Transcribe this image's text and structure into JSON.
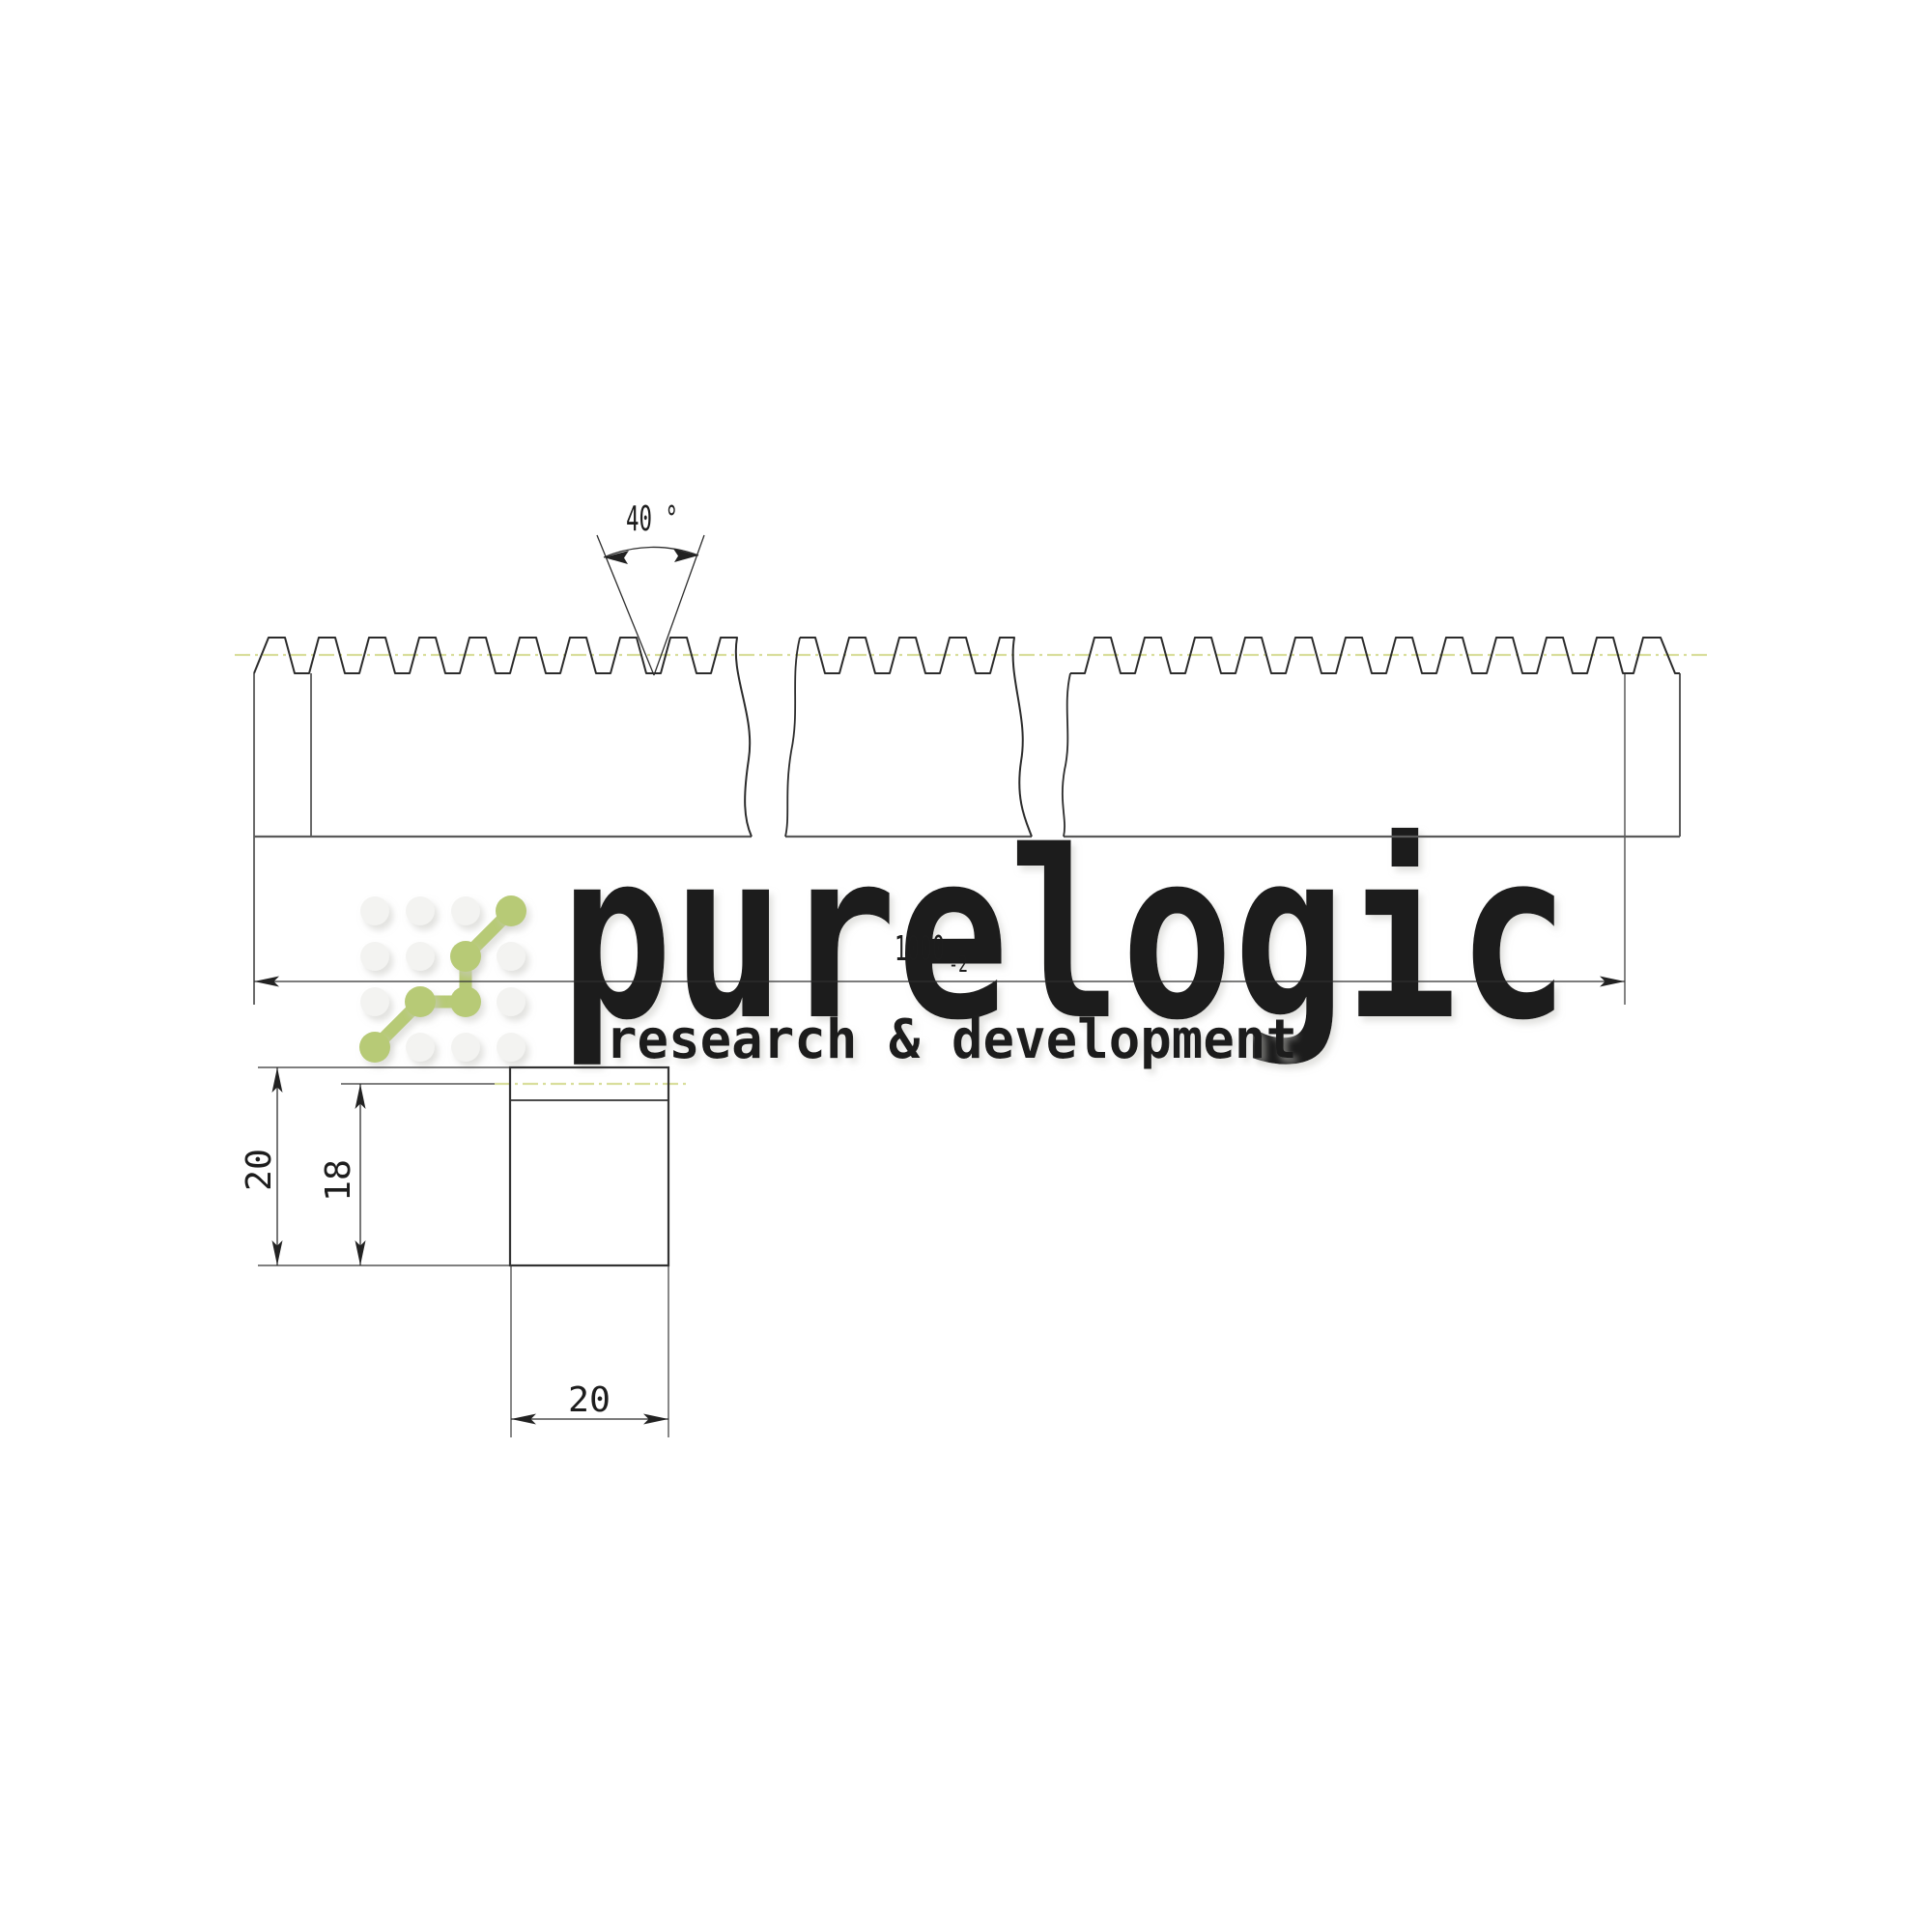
{
  "watermark": {
    "brand": "purelogic",
    "tagline": "research & development",
    "accent_green": "#b7ca76",
    "dot_gray": "#f3f3f1"
  },
  "drawing": {
    "type": "gear-rack technical drawing",
    "pitch_line_color": "#d9de9c",
    "line_color": "#2b2b2b",
    "dimensions": {
      "tooth_angle": "40 °",
      "length": "1000",
      "length_tolerance": "-2",
      "section_height": "20",
      "pitch_height": "18",
      "section_width": "20"
    }
  }
}
